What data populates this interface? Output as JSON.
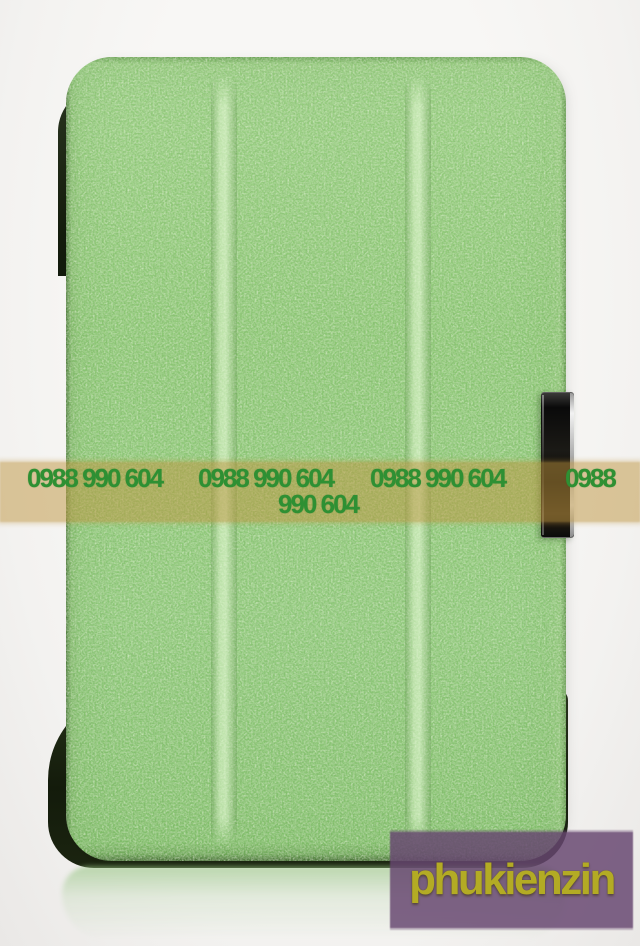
{
  "photo": {
    "description": "Product photo of a green silk-textured tri-fold smart cover case standing upright on a white studio background with a floor reflection"
  },
  "case": {
    "color": "#8cc676",
    "edge_color": "#1b2410",
    "clasp_color": "#0d0c09",
    "clasp_rim_color": "#d9d9d9",
    "panel_count": 3
  },
  "watermark": {
    "phone_number": "0988 990 604",
    "line1_items": [
      "0988 990 604",
      "0988 990 604",
      "0988 990 604",
      "0988"
    ],
    "line2": "990 604",
    "text_color": "#2e9033",
    "band_color": "#be943e"
  },
  "brand": {
    "label": "phukienzin",
    "bg_color": "#674670",
    "text_color": "#b3ab24"
  }
}
